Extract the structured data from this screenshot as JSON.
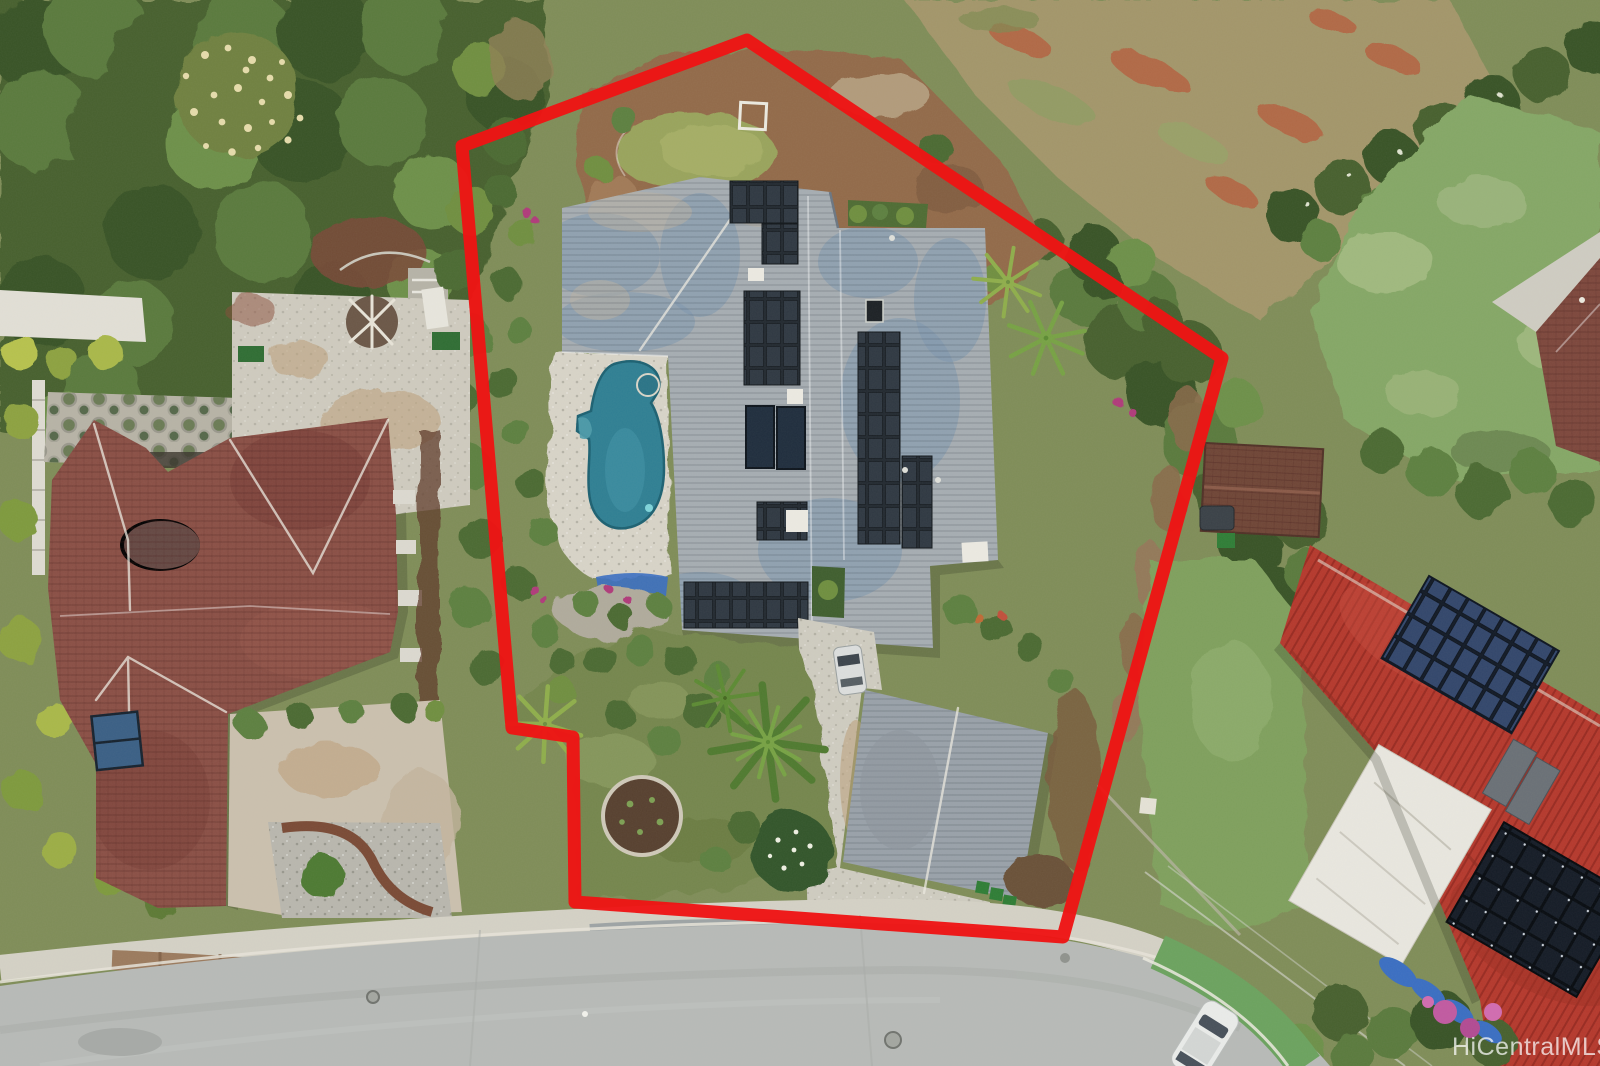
{
  "meta": {
    "kind": "aerial-photograph",
    "caption": "Drone aerial view of a residential property outlined in red",
    "width_px": 1600,
    "height_px": 1066
  },
  "watermark": {
    "text": "HiCentralMLS"
  },
  "boundary": {
    "points": "747,40 1222,358 1063,937 575,902 573,737 512,728 462,146",
    "color": "#ee1414",
    "stroke_width": 13
  },
  "colors": {
    "boundary_red": "#ee1414",
    "subject_roof": "#a6adb2",
    "garage_roof": "#99a1a9",
    "solar_panel_cell": "#2f3842",
    "solar_panel_bg": "#222930",
    "solar_heater": "#1f2d3d",
    "pool_water": "#2f7f93",
    "pool_deck": "#d8d4c8",
    "left_roof": "#8a4f45",
    "right_roof": "#b5382c",
    "right_solar_cell": "#32466b",
    "right_solar_dark": "#141b26",
    "patio_roof": "#e9e7df",
    "forest": "#47602f",
    "scrub": "#7b8b50",
    "dry_field": "#a3966a",
    "lawn_right": "#85a766",
    "subject_lawn": "#75864e",
    "dirt": "#926a49",
    "concrete": "#cfccc0",
    "road": "#b7bab7",
    "bike_lane": "#6ba25e",
    "tarp_blue": "#3a6ec2",
    "bougainvillea": "#c159a0"
  },
  "objects": {
    "subject": [
      "red property boundary outline",
      "gray shingle roof with rooftop solar arrays",
      "two solar water heater panels",
      "kidney-shaped swimming pool",
      "stone pool deck",
      "blue pool cover roll",
      "detached garage",
      "concrete driveway with parked car",
      "front lawn with circular mulch planter",
      "coconut palms",
      "white square frame in upper yard",
      "small upper lawn",
      "green and blue trash bins"
    ],
    "left_neighbor": [
      "maroon tile hip roof",
      "rooftop solar water panel",
      "potted-plant gravel garden",
      "concrete courtyard with driftwood sculpture",
      "gravel yard with round shrub",
      "curved brick edging"
    ],
    "right_neighbor": [
      "red corrugated metal roof",
      "blue solar panel array",
      "dark solar panel array",
      "white flat patio roof",
      "brown garden shed",
      "dark pickup truck",
      "lawn strip",
      "hedge with pink bougainvillea",
      "blue tarps"
    ],
    "surroundings": [
      "dense tree canopy",
      "flowering tree with cream blossoms",
      "dry brush field",
      "mottled green lawns",
      "curved street with green bike lane",
      "white car on street",
      "HiCentralMLS watermark"
    ]
  }
}
